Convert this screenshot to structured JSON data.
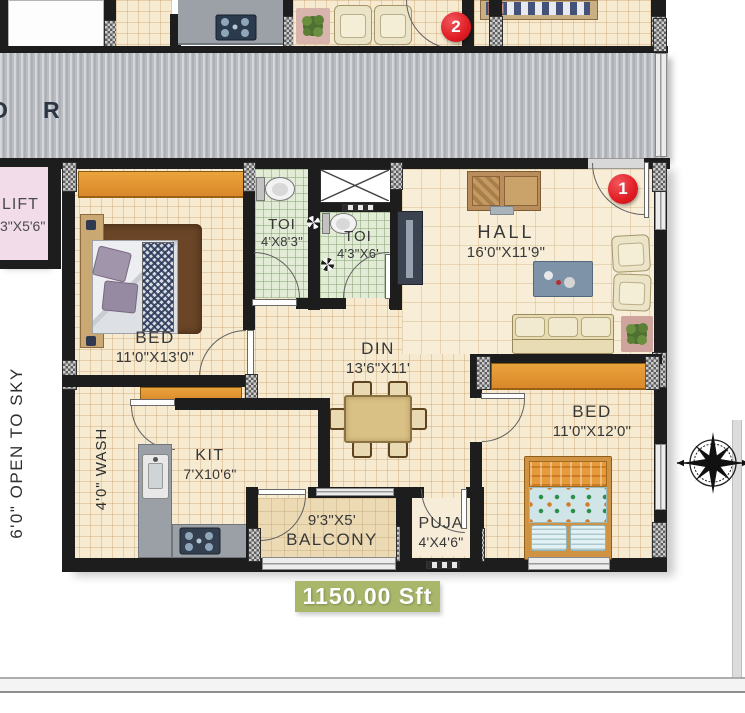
{
  "corridor": {
    "letter1": "O",
    "letter2": "R"
  },
  "lift": {
    "name": "LIFT",
    "dims": "3\"X5'6\""
  },
  "open_to_sky": "6'0\" OPEN TO SKY",
  "rooms": {
    "bed1": {
      "name": "BED",
      "dims": "11'0\"X13'0\""
    },
    "toi1": {
      "name": "TOI",
      "dims": "4'X8'3\""
    },
    "toi2": {
      "name": "TOI",
      "dims": "4'3\"X6'"
    },
    "hall": {
      "name": "HALL",
      "dims": "16'0\"X11'9\""
    },
    "din": {
      "name": "DIN",
      "dims": "13'6\"X11'"
    },
    "bed2": {
      "name": "BED",
      "dims": "11'0\"X12'0\""
    },
    "kit": {
      "name": "KIT",
      "dims": "7'X10'6\""
    },
    "wash": {
      "label": "4'0\" WASH"
    },
    "balcony": {
      "name": "BALCONY",
      "dims": "9'3\"X5'"
    },
    "puja": {
      "name": "PUJA",
      "dims": "4'X4'6\""
    }
  },
  "markers": {
    "unit1": "1",
    "unit2": "2"
  },
  "area_badge": "1150.00 Sft",
  "icons": {
    "compass": "compass-rose",
    "fan": "exhaust-fan",
    "shaft": "duct-cross"
  },
  "colors": {
    "wall": "#1d1d1d",
    "floor_tile": "#f6ead0",
    "toilet_tile": "#e2ebd6",
    "corridor": "#babec3",
    "wardrobe_orange": "#e2912f",
    "lift_pink": "#f3dcea",
    "badge_green": "#a9b76a",
    "marker_red": "#e01b22",
    "counter_gray": "#9aa0a5"
  }
}
